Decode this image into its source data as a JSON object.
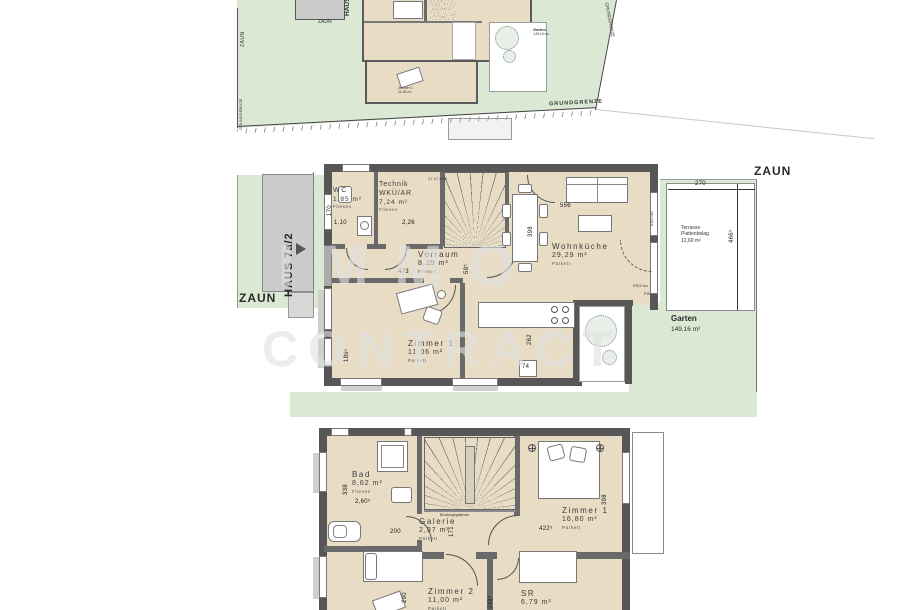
{
  "watermark": {
    "line1": "IMMO",
    "line2": "CONTRACT"
  },
  "site_plan": {
    "zaun_vertical": "ZAUN",
    "grundgrenze_left": "GRUNDGRENZE",
    "grundgrenze_bottom": "GRUNDGRENZE",
    "grundgrenze_right": "GRUNDGRENZE",
    "neighbor_zaun": "ZAUN",
    "neighbor_haus": "HAUS",
    "garten_label": "Garten",
    "garten_area": "149,16 m²",
    "mini_room": "Zimmer 1",
    "mini_room_area": "11,06 m²"
  },
  "ground_floor": {
    "haus_label": "HAUS 7a/2",
    "zaun_left": "ZAUN",
    "zaun_right": "ZAUN",
    "garten_label": "Garten",
    "garten_area": "149,16 m²",
    "terrasse_name": "Terrasse",
    "terrasse_surface": "Plattenbelag",
    "terrasse_area": "12,60 m²",
    "stair_note": "17 17,3/26",
    "glass_east": "ESG iso",
    "glass_south": "ESG iso",
    "glass_fix": "FIX",
    "rooms": {
      "wc": {
        "name": "WC",
        "area": "1,85 m²",
        "floor": "Fliesen"
      },
      "technik": {
        "name": "Technik",
        "name2": "WKÜ/AR",
        "area": "7,24 m²",
        "floor": "Fliesen"
      },
      "vorraum": {
        "name": "Vorraum",
        "area": "8,29 m²",
        "floor": "Fliesen"
      },
      "zimmer1": {
        "name": "Zimmer 1",
        "area": "11,06 m²",
        "floor": "Parkett"
      },
      "wohnkueche": {
        "name": "Wohnküche",
        "area": "29,29 m²",
        "floor": "Parkett"
      }
    },
    "dims": {
      "wc_w": "1,10",
      "wc_h": "170",
      "technik_w": "2,26",
      "vorraum_w": "473",
      "vorraum_h": "58⁵",
      "wohnkueche_w": "556",
      "ess_h": "398",
      "zimmer1_h": "189⁵",
      "kueche_h": "262",
      "kueche_w": "74",
      "terrasse_w": "270",
      "terrasse_h": "466⁵"
    }
  },
  "upper_floor": {
    "railing_note": "Brüstungsgeländer",
    "rooms": {
      "bad": {
        "name": "Bad",
        "area": "8,62 m²",
        "floor": "Fliesen"
      },
      "galerie": {
        "name": "Galerie",
        "area": "2,97 m²",
        "floor": "Parkett"
      },
      "zimmer1": {
        "name": "Zimmer 1",
        "area": "16,80 m²",
        "floor": "Parkett"
      },
      "zimmer2": {
        "name": "Zimmer 2",
        "area": "11,00 m²",
        "floor": "Parkett"
      },
      "sr": {
        "name": "SR",
        "area": "6,79 m²"
      }
    },
    "dims": {
      "bad_h": "338",
      "bad_w": "2,60⁵",
      "galerie_w": "200",
      "galerie_h": "171",
      "zimmer1_w": "422⁵",
      "zimmer1_h": "398",
      "zimmer2_h": "290",
      "sr_h": "248⁵"
    }
  }
}
